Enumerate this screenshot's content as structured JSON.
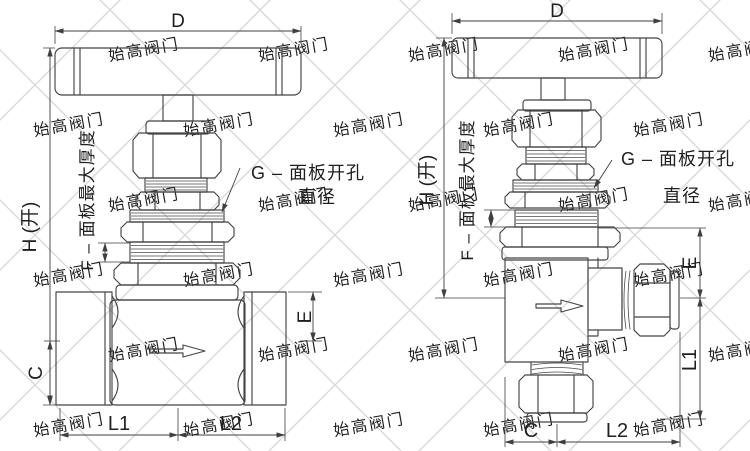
{
  "watermark": {
    "text": "始高阀门",
    "color": "#c7c7c7",
    "lattice_color": "#d7d7d7",
    "rotation": -10,
    "x_step": 150,
    "rows": [
      {
        "y": 55,
        "x_start": 145
      },
      {
        "y": 130,
        "x_start": 70
      },
      {
        "y": 205,
        "x_start": 145
      },
      {
        "y": 280,
        "x_start": 70
      },
      {
        "y": 355,
        "x_start": 145
      },
      {
        "y": 430,
        "x_start": 70
      }
    ]
  },
  "left_valve": {
    "labels": {
      "width": "D",
      "height": "H (开)",
      "panel_thickness": "F – 面板最大厚度",
      "panel_hole_line1": "G – 面板开孔",
      "panel_hole_line2": "直径",
      "port_top": "E",
      "port_bottom": "C",
      "length_left": "L1",
      "length_right": "L2"
    }
  },
  "right_valve": {
    "labels": {
      "width": "D",
      "height": "H (开)",
      "panel_thickness": "F – 面板最大厚度",
      "panel_hole_line1": "G – 面板开孔",
      "panel_hole_line2": "直径",
      "outlet_top": "E",
      "outlet_length": "L1",
      "inlet_offset": "C",
      "length_right": "L2"
    }
  }
}
